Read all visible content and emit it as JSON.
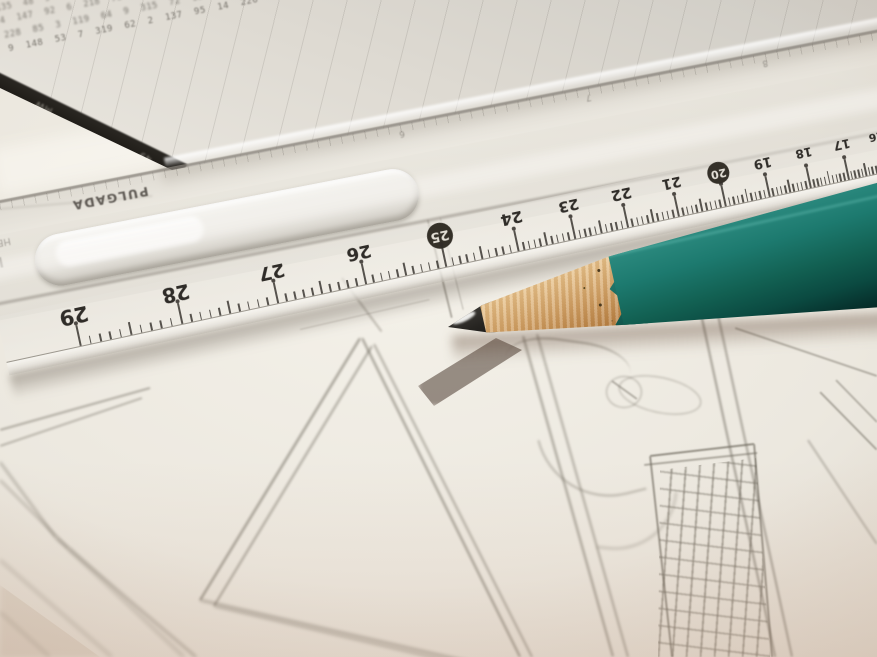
{
  "scene": {
    "description": "Close-up photograph: a freshly sharpened teal pencil and a transparent plastic ruler lie diagonally across a hand-drawn pencil sketch of comic panels and a skyscraper; an out-of-focus printed data table sits at the top of the frame.",
    "lighting": "warm desk light, bright centre, soft warm vignette at the edges"
  },
  "palette": {
    "paper_base": "#ece8df",
    "paper_bright": "#f5f2ea",
    "table_text": "#615d56",
    "black_strip": "#211e1a",
    "sketch_line": "#6f6a5f",
    "ruler_number": "#2f2c28",
    "pencil_teal": "#1d7a6f",
    "pencil_wood": "#d2a267",
    "graphite": "#262421"
  },
  "table_paper": {
    "description": "out-of-focus printed spreadsheet of small numbers with a black edge strip",
    "strip_marks": [
      {
        "label": "MW",
        "x": 52
      },
      {
        "label": "49",
        "x": 168
      }
    ],
    "rows": [
      "418  27  9  118  3  842  56  12  7  336  94  8  215  41  6  119  83  2  147  58  9  312  76  4  128",
      "92  315  8  47  126  5  218  63  9  114  38  2  419  57  13  86  241  7  119  34  6  158  92  3  217",
      "6  148  52  9  317  84  2  126  45  8  219  67  3  118  96  14  332  58  7  214  83  5  149  28  116",
      "217  38  6  124  59  8  316  47  2  138  95  13  248  76  4  119  52  9  327  68  5  142  87  3  216",
      "84  219  5  136  42  9  118  67  3  325  91  7  214  58  12  147  36  8  229  74  6  113  95  2  318",
      "3  127  86  14  248  59  7  119  42  6  317  95  2  138  64  9  226  57  8  314  91  5  148  73  217",
      "158  47  9  226  38  5  119  84  2  317  62  13  149  95  7  238  56  4  127  83  9  315  48  6  214",
      "7  319  54  8  127  96  3  248  61  14  138  75  2  219  47  9  316  88  5  124  63  7  215  39  148",
      "126  58  4  317  92  7  148  36  9  225  81  3  119  67  13  342  54  8  217  95  6  138  42  5  319",
      "9  214  67  5  138  49  8  326  72  3  119  85  14  247  53  7  318  96  2  125  68  9  213  47  136",
      "317  46  8  129  63  5  248  97  2  136  54  13  219  78  4  115  92  7  324  58  6  147  83  9  218",
      "5  148  73  9  316  58  2  127  94  7  239  46  14  118  65  3  227  89  8  314  52  6  139  97  215",
      "219  64  7  135  48  9  327  86  3  124  57  2  318  93  13  146  75  8  228  54  6  117  98  4  315",
      "8  326  59  4  147  92  6  218  73  14  139  56  2  317  84  9  125  48  7  236  95  5  114  67  219",
      "137  49  6  228  85  3  119  64  9  315  72  13  146  58  7  234  91  2  128  56  8  317  94  5  213",
      "4  217  86  9  148  53  7  319  62  2  137  95  14  226  48  6  118  74  8  325  57  3  149  92  216"
    ]
  },
  "ruler": {
    "material": "transparent plastic",
    "top_scale_label": "PULGADA",
    "brand_text": "HECHO",
    "logo_glyph": "W",
    "unit": "cm",
    "inch_numbers": [
      {
        "label": "6",
        "x": 430
      },
      {
        "label": "7",
        "x": 620
      },
      {
        "label": "8",
        "x": 800
      }
    ],
    "cm_numbers": [
      {
        "label": "29",
        "x": 76,
        "size": 21,
        "circled": false
      },
      {
        "label": "28",
        "x": 180,
        "size": 20,
        "circled": false
      },
      {
        "label": "27",
        "x": 278,
        "size": 19,
        "circled": false
      },
      {
        "label": "26",
        "x": 368,
        "size": 18,
        "circled": false
      },
      {
        "label": "25",
        "x": 450,
        "size": 17,
        "circled": true
      },
      {
        "label": "24",
        "x": 524,
        "size": 16,
        "circled": false
      },
      {
        "label": "23",
        "x": 582,
        "size": 15,
        "circled": false
      },
      {
        "label": "22",
        "x": 636,
        "size": 15,
        "circled": false
      },
      {
        "label": "21",
        "x": 688,
        "size": 14,
        "circled": false
      },
      {
        "label": "20",
        "x": 736,
        "size": 14,
        "circled": true
      },
      {
        "label": "19",
        "x": 781,
        "size": 13,
        "circled": false
      },
      {
        "label": "18",
        "x": 823,
        "size": 12,
        "circled": false
      },
      {
        "label": "17",
        "x": 862,
        "size": 12,
        "circled": false
      },
      {
        "label": "16",
        "x": 898,
        "size": 11,
        "circled": false
      }
    ]
  },
  "pencil": {
    "color_name": "teal",
    "state": "freshly sharpened, rough whittled collar with dark specks, bare graphite tip with specular highlight"
  },
  "sketch": {
    "subjects": [
      "large comic panel borders in perspective",
      "skyscraper with window grid",
      "two overlapping cloud/balloon ellipses",
      "curved scribble tail"
    ],
    "strokes": [
      [
        360,
        338,
        200,
        600,
        2.2,
        1.2,
        0.7
      ],
      [
        372,
        346,
        214,
        606,
        2.0,
        1.3,
        0.55
      ],
      [
        200,
        600,
        470,
        662,
        2.4,
        1.8,
        0.6
      ],
      [
        214,
        606,
        478,
        668,
        2.2,
        1.8,
        0.5
      ],
      [
        362,
        338,
        520,
        657,
        2.2,
        1.4,
        0.65
      ],
      [
        374,
        344,
        532,
        657,
        2.0,
        1.4,
        0.5
      ],
      [
        0,
        430,
        150,
        388,
        1.8,
        1.0,
        0.5
      ],
      [
        0,
        446,
        142,
        398,
        1.6,
        1.1,
        0.42
      ],
      [
        0,
        462,
        56,
        538,
        2.0,
        1.6,
        0.5
      ],
      [
        56,
        538,
        196,
        657,
        2.2,
        1.9,
        0.55
      ],
      [
        0,
        480,
        68,
        548,
        1.8,
        1.7,
        0.42
      ],
      [
        68,
        548,
        184,
        657,
        2.0,
        2.0,
        0.45
      ],
      [
        0,
        560,
        112,
        657,
        2.0,
        2.0,
        0.4
      ],
      [
        0,
        612,
        50,
        657,
        1.8,
        2.1,
        0.32
      ],
      [
        342,
        278,
        382,
        332,
        1.5,
        1.0,
        0.4
      ],
      [
        428,
        220,
        452,
        318,
        1.5,
        0.8,
        0.5
      ],
      [
        440,
        218,
        463,
        310,
        1.4,
        0.8,
        0.4
      ],
      [
        300,
        330,
        430,
        300,
        1.4,
        0.9,
        0.3
      ],
      [
        523,
        336,
        613,
        657,
        2.2,
        1.2,
        0.6
      ],
      [
        537,
        334,
        628,
        657,
        2.0,
        1.2,
        0.5
      ],
      [
        612,
        381,
        637,
        399,
        1.5,
        0.9,
        0.45
      ],
      [
        700,
        310,
        775,
        657,
        2.4,
        1.1,
        0.6
      ],
      [
        716,
        306,
        792,
        657,
        2.2,
        1.1,
        0.55
      ],
      [
        735,
        328,
        877,
        376,
        1.8,
        0.9,
        0.45
      ],
      [
        820,
        392,
        877,
        450,
        2.0,
        0.9,
        0.5
      ],
      [
        836,
        380,
        877,
        422,
        1.6,
        0.9,
        0.42
      ],
      [
        808,
        440,
        877,
        544,
        1.6,
        1.1,
        0.4
      ],
      [
        650,
        456,
        754,
        444,
        2.2,
        0.8,
        0.7
      ],
      [
        644,
        465,
        757,
        453,
        1.8,
        0.8,
        0.5
      ],
      [
        650,
        456,
        672,
        657,
        2.2,
        0.9,
        0.65
      ],
      [
        754,
        444,
        772,
        657,
        2.2,
        0.9,
        0.65
      ],
      [
        0,
        209,
        152,
        196,
        1.6,
        1.0,
        0.28
      ]
    ],
    "ellipses": [
      {
        "cx": 659,
        "cy": 394,
        "rx": 41,
        "ry": 17,
        "rot": 12,
        "o": 0.5,
        "b": 1.1
      },
      {
        "cx": 623,
        "cy": 391,
        "rx": 17,
        "ry": 15,
        "rot": 0,
        "o": 0.5,
        "b": 1.1
      }
    ],
    "building": {
      "window_columns": 7,
      "window_rows": 11
    }
  }
}
